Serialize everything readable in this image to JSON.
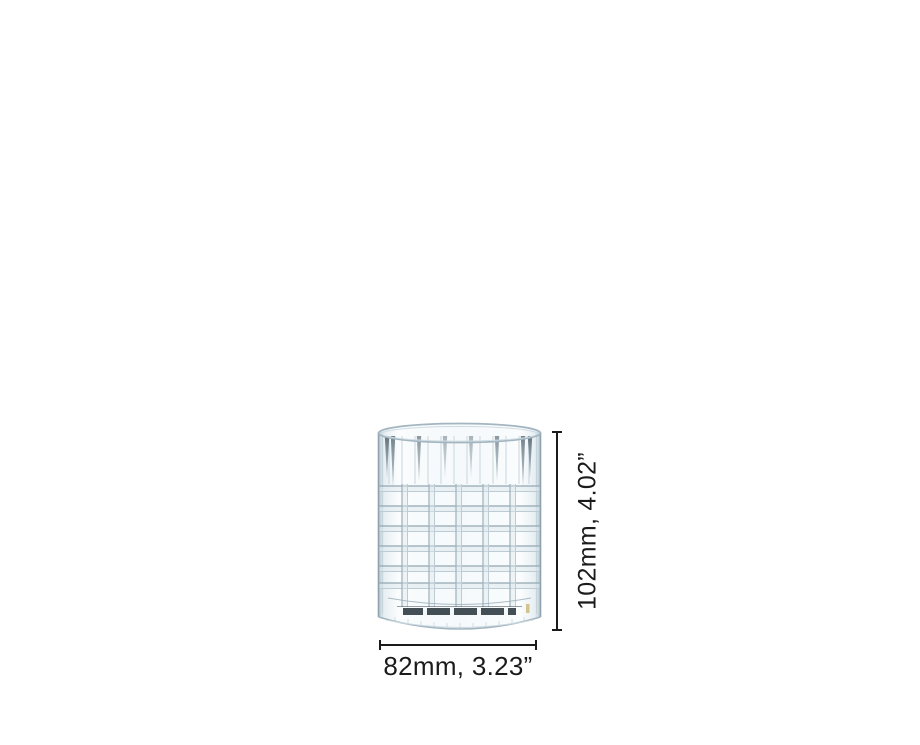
{
  "canvas": {
    "width_px": 920,
    "height_px": 745,
    "background": "#ffffff"
  },
  "figure": {
    "type": "product-dimension-illustration",
    "subject": "crystal-cut-whiskey-tumbler"
  },
  "dimensions": {
    "height": {
      "label": "102mm, 4.02”",
      "mm": 102,
      "inches": 4.02
    },
    "width": {
      "label": "82mm, 3.23”",
      "mm": 82,
      "inches": 3.23
    },
    "line_color": "#1b1b1b",
    "label_color": "#1b1b1b"
  }
}
